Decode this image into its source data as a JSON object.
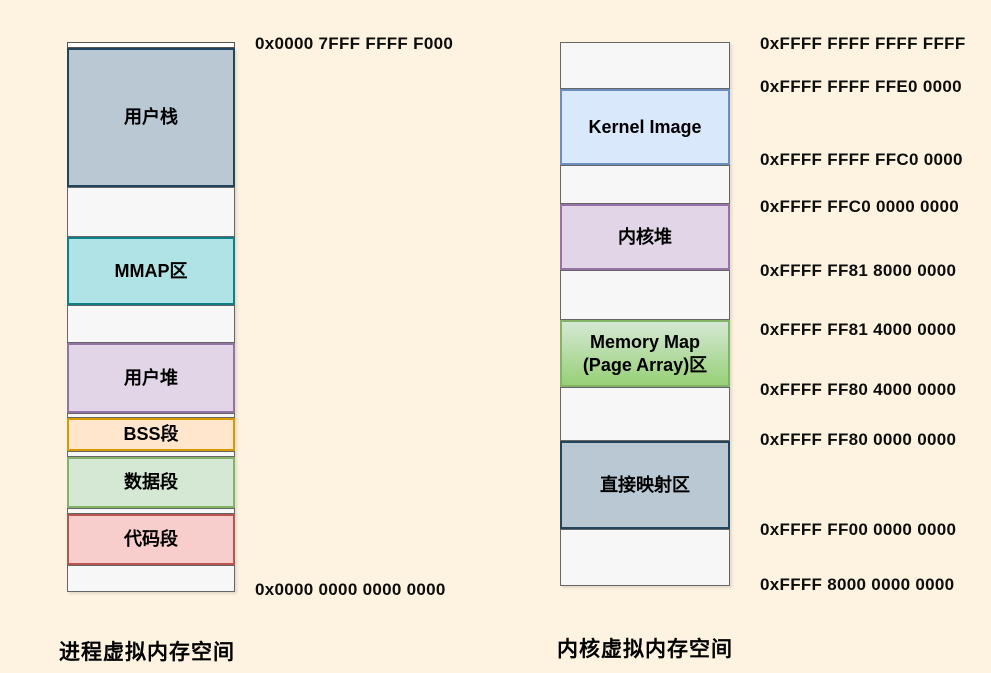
{
  "diagram_title": "virtual memory layout",
  "palette": {
    "background": "#fdf3e0",
    "blue_gray_fill": "#bac8d3",
    "blue_gray_border": "#23445d",
    "teal_fill": "#b0e3e6",
    "teal_border": "#0e8088",
    "purple_fill": "#e1d5e7",
    "purple_border": "#9673a6",
    "orange_fill": "#ffe6cc",
    "orange_border": "#d79b00",
    "green_fill": "#d5e8d4",
    "green_border": "#82b366",
    "red_fill": "#f8cecc",
    "red_border": "#b85450",
    "blue_fill": "#dae8fc",
    "blue_border": "#6c8ebf",
    "green_gradient_start": "#d5e8d4",
    "green_gradient_end": "#97d077",
    "filler_fill": "#f5f5f5",
    "filler_border": "#666666",
    "text": "#000000"
  },
  "left_column": {
    "caption": "进程虚拟内存空间",
    "top_address": "0x0000 7FFF FFFF F000",
    "bottom_address": "0x0000 0000 0000 0000",
    "segments": [
      {
        "label": "用户栈",
        "fill": "#bac8d3",
        "border": "#23445d"
      },
      {
        "label": "MMAP区",
        "fill": "#b0e3e6",
        "border": "#0e8088"
      },
      {
        "label": "用户堆",
        "fill": "#e1d5e7",
        "border": "#9673a6"
      },
      {
        "label": "BSS段",
        "fill": "#ffe6cc",
        "border": "#d79b00"
      },
      {
        "label": "数据段",
        "fill": "#d5e8d4",
        "border": "#82b366"
      },
      {
        "label": "代码段",
        "fill": "#f8cecc",
        "border": "#b85450"
      }
    ]
  },
  "right_column": {
    "caption": "内核虚拟内存空间",
    "segments": [
      {
        "label": "Kernel Image",
        "fill": "#dae8fc",
        "border": "#6c8ebf"
      },
      {
        "label": "内核堆",
        "fill": "#e1d5e7",
        "border": "#9673a6"
      },
      {
        "label": "Memory Map (Page Array)区",
        "fill": "#d5e8d4",
        "fill_end": "#97d077",
        "border": "#82b366"
      },
      {
        "label": "直接映射区",
        "fill": "#bac8d3",
        "border": "#23445d"
      }
    ],
    "addresses": [
      {
        "text": "0xFFFF FFFF FFFF FFFF"
      },
      {
        "text": "0xFFFF FFFF FFE0 0000"
      },
      {
        "text": "0xFFFF FFFF FFC0 0000"
      },
      {
        "text": "0xFFFF FFC0 0000 0000"
      },
      {
        "text": "0xFFFF FF81 8000 0000"
      },
      {
        "text": "0xFFFF FF81 4000 0000"
      },
      {
        "text": "0xFFFF FF80 4000 0000"
      },
      {
        "text": "0xFFFF FF80 0000 0000"
      },
      {
        "text": "0xFFFF FF00 0000 0000"
      },
      {
        "text": "0xFFFF 8000 0000 0000"
      }
    ]
  }
}
